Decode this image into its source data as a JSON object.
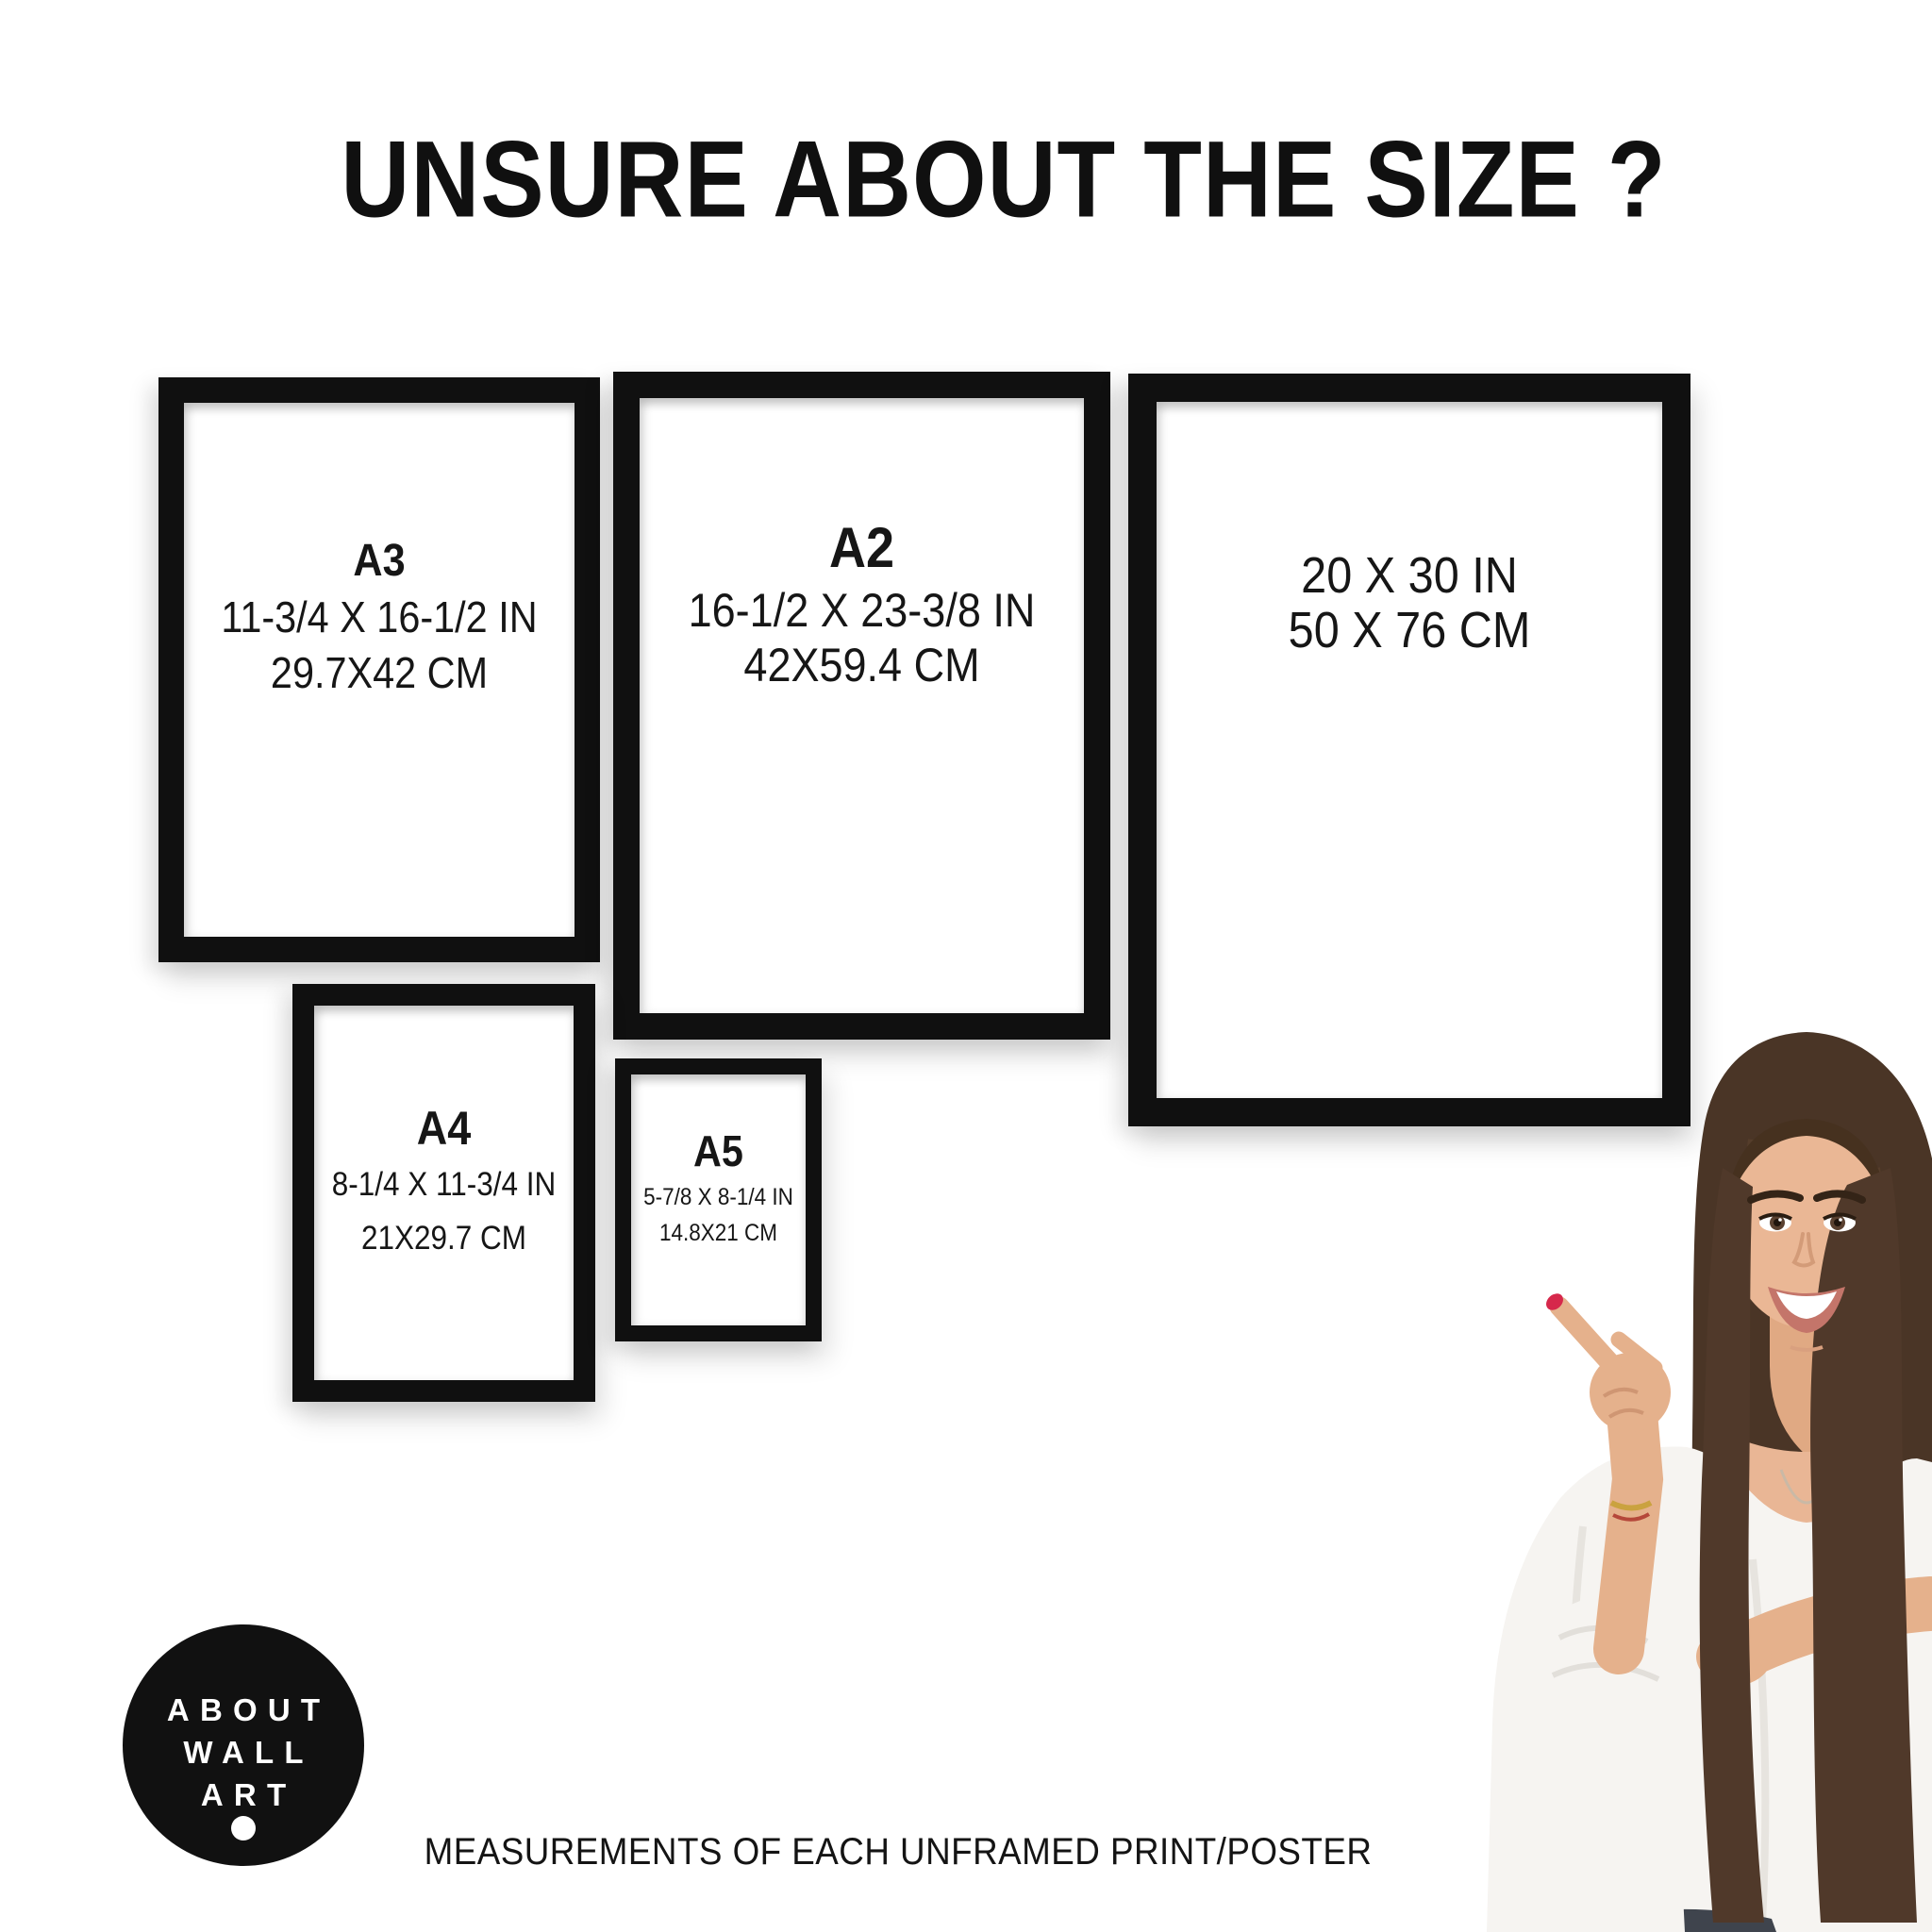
{
  "title": "UNSURE ABOUT THE SIZE ?",
  "footer_note": "MEASUREMENTS OF EACH UNFRAMED PRINT/POSTER",
  "logo": {
    "line1": "ABOUT",
    "line2": "WALL",
    "line3": "ART"
  },
  "frames": [
    {
      "label": "A3",
      "inches": "11-3/4 X 16-1/2 IN",
      "cm": "29.7X42 CM"
    },
    {
      "label": "A2",
      "inches": "16-1/2 X 23-3/8 IN",
      "cm": "42X59.4 CM"
    },
    {
      "label": "",
      "inches": "20 X 30 IN",
      "cm": "50 X 76 CM"
    },
    {
      "label": "A4",
      "inches": "8-1/4 X 11-3/4 IN",
      "cm": "21X29.7 CM"
    },
    {
      "label": "A5",
      "inches": "5-7/8 X 8-1/4 IN",
      "cm": "14.8X21 CM"
    }
  ],
  "colors": {
    "background": "#ffffff",
    "frame_black": "#101010",
    "text": "#141414",
    "logo_background": "#111111",
    "logo_text": "#ffffff",
    "nail_red": "#d6284b",
    "hair_brown": "#4a3526",
    "skin": "#e9b695",
    "blouse_white": "#f6f4f1",
    "jeans_dark": "#3f444d"
  }
}
